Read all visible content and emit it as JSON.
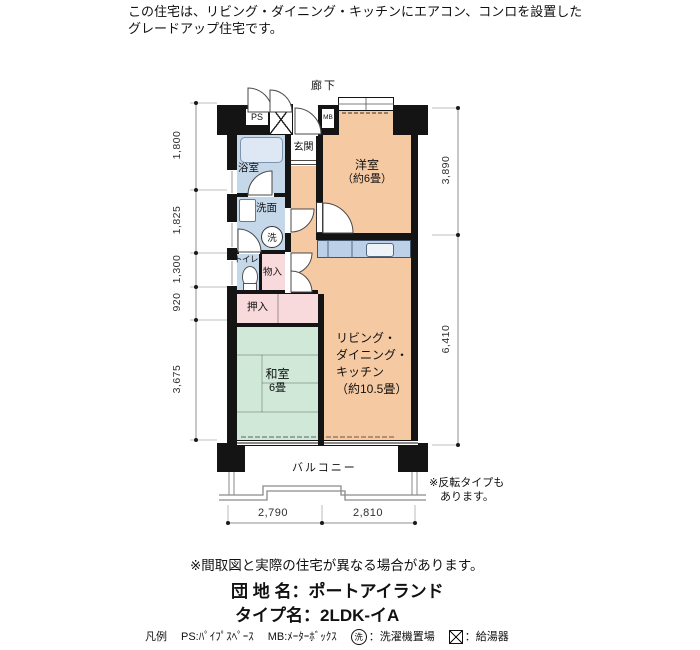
{
  "header": {
    "line1": "この住宅は、リビング・ダイニング・キッチンにエアコン、コンロを設置した",
    "line2": "グレードアップ住宅です。"
  },
  "plan": {
    "corridor": "廊下",
    "rooms": {
      "genkan": "玄関",
      "bath": "浴室",
      "washroom": "洗面",
      "toilet": "トイレ",
      "storage": "物入",
      "closet": "押入",
      "western": {
        "name": "洋室",
        "size": "（約6畳）"
      },
      "japanese": {
        "name": "和室",
        "size": "6畳"
      },
      "ldk": {
        "lines": [
          "リビング・",
          "ダイニング・",
          "キッチン",
          "（約10.5畳）"
        ]
      },
      "balcony": "バルコニー"
    },
    "fixtures": {
      "ps": "PS",
      "mb": "MB",
      "washer": "洗"
    },
    "dimensions": {
      "left": [
        "1,800",
        "1,825",
        "1,300",
        "920",
        "3,675"
      ],
      "right": [
        "3,890",
        "6,410"
      ],
      "bottom": [
        "2,790",
        "2,810"
      ]
    },
    "flip_note": {
      "line1": "※反転タイプも",
      "line2": "あります。"
    }
  },
  "footer": {
    "disclaimer": "※間取図と実際の住宅が異なる場合があります。",
    "estate_name": "団 地 名：ポートアイランド",
    "type_name": "タイプ名：2LDK-イA",
    "legend": {
      "title": "凡例",
      "ps": "PS:ﾊﾟｲﾌﾟｽﾍﾟｰｽ",
      "mb": "MB:ﾒｰﾀｰﾎﾞｯｸｽ",
      "washer_symbol": "洗",
      "washer_label": "：洗濯機置場",
      "heater_label": "：給湯器"
    }
  },
  "colors": {
    "room_orange": "#f5c9a2",
    "room_green": "#d0e8d8",
    "room_blue": "#c5d8ea",
    "room_pink": "#f8d9dc",
    "counter_blue": "#bcd1e8",
    "wall_black": "#141414"
  }
}
